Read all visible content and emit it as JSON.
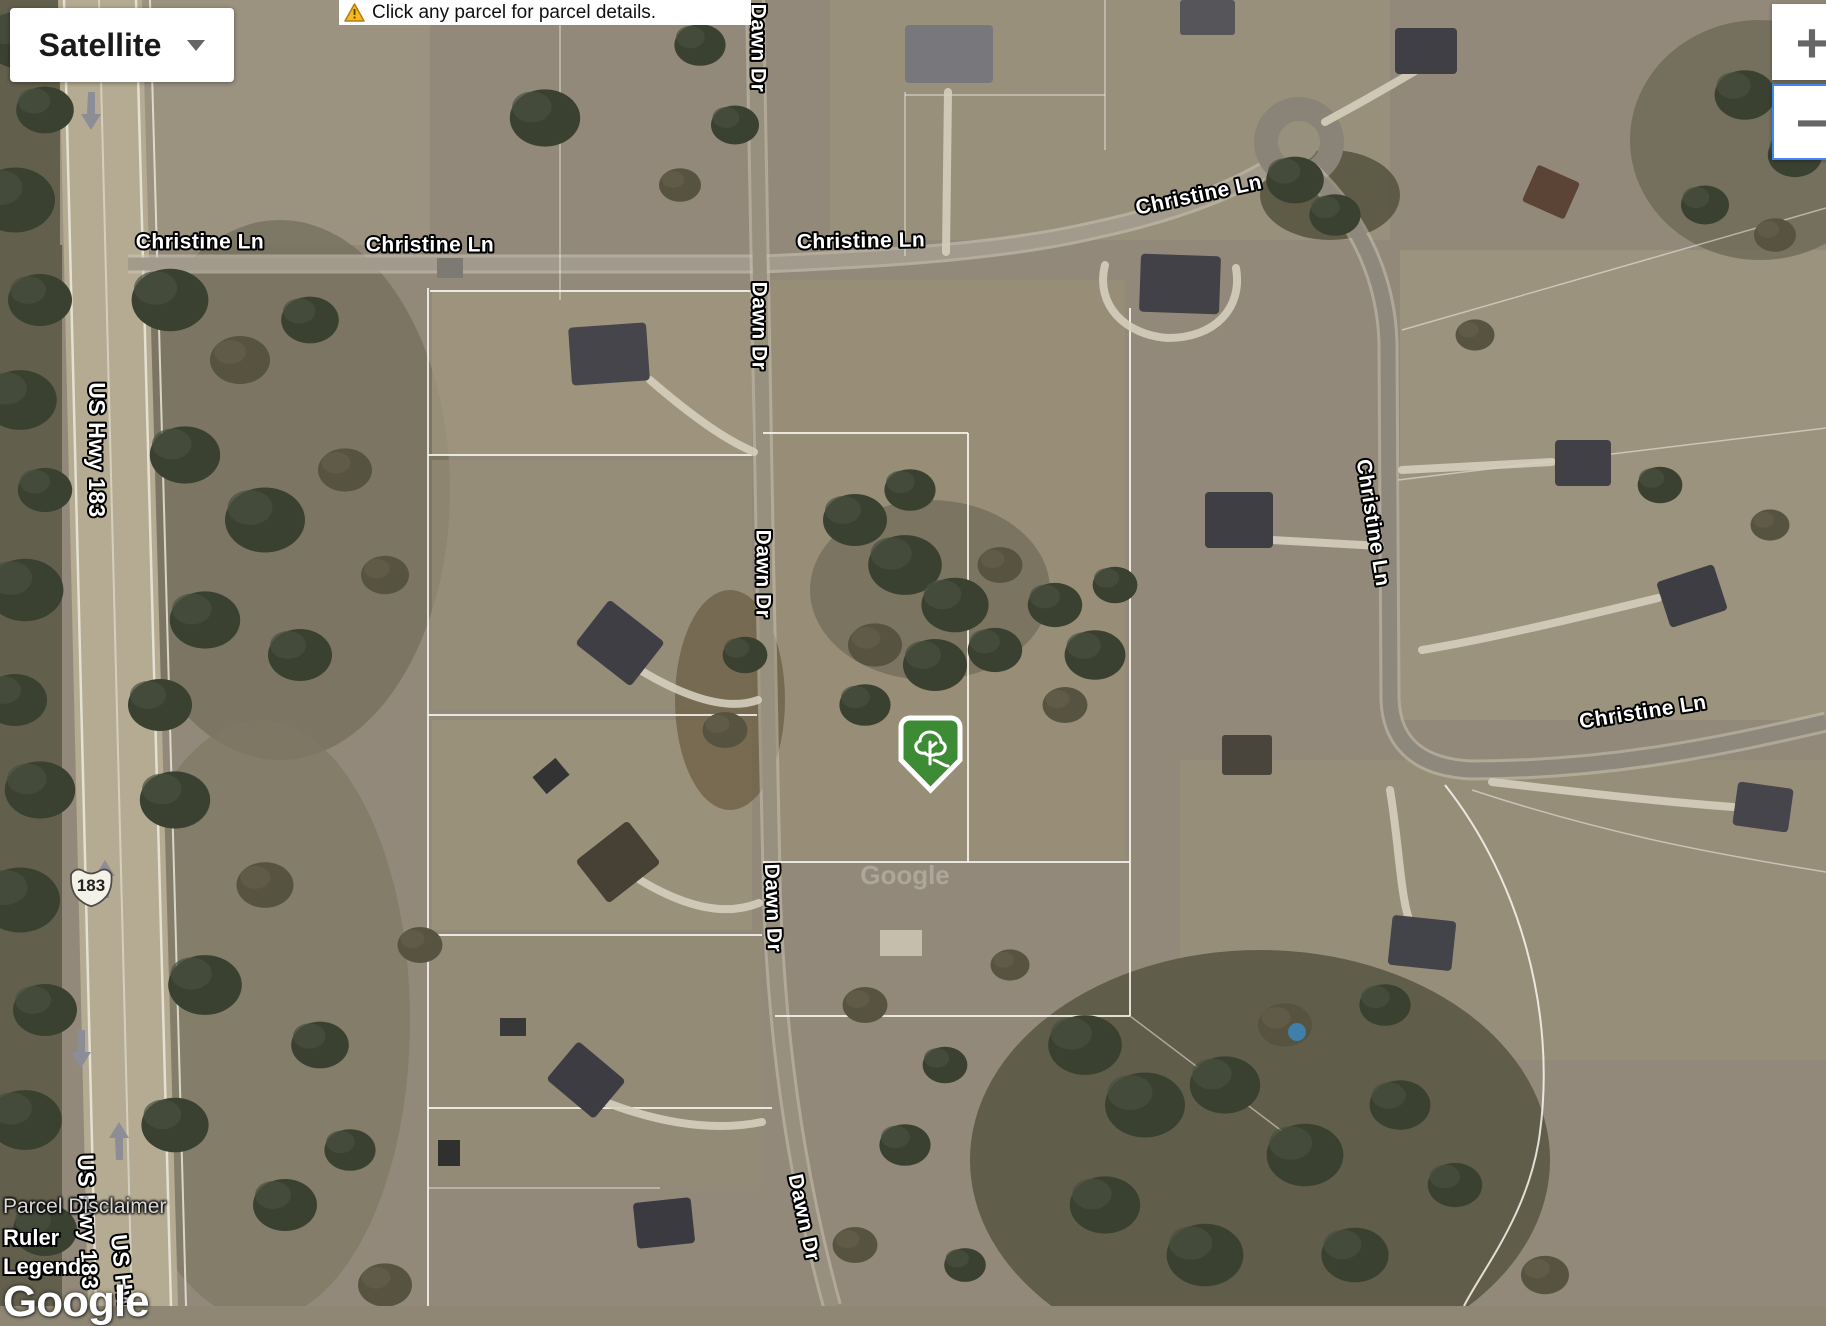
{
  "controls": {
    "map_type_label": "Satellite",
    "zoom_in_label": "+",
    "zoom_out_label": "−"
  },
  "notification": {
    "icon": "warning-triangle-icon",
    "text": "Click any parcel for parcel details."
  },
  "links": {
    "parcel_disclaimer": "Parcel Disclaimer",
    "ruler": "Ruler",
    "legend": "Legend"
  },
  "attribution": {
    "logo_text": "Google",
    "watermark_text": "Google"
  },
  "map": {
    "highway_shield": {
      "route": "183"
    },
    "marker": {
      "x": 901,
      "y": 718,
      "color": "#3d8b35",
      "icon": "tree-icon"
    },
    "road_labels": [
      {
        "text": "Christine Ln",
        "x": 200,
        "y": 243,
        "rot": 0
      },
      {
        "text": "Christine Ln",
        "x": 430,
        "y": 246,
        "rot": 0
      },
      {
        "text": "Christine Ln",
        "x": 861,
        "y": 242,
        "rot": -1
      },
      {
        "text": "Christine Ln",
        "x": 1199,
        "y": 196,
        "rot": -12
      },
      {
        "text": "Christine Ln",
        "x": 1372,
        "y": 523,
        "rot": 81
      },
      {
        "text": "Christine Ln",
        "x": 1643,
        "y": 713,
        "rot": -9
      },
      {
        "text": "Dawn Dr",
        "x": 757,
        "y": 48,
        "rot": 90
      },
      {
        "text": "Dawn Dr",
        "x": 758,
        "y": 326,
        "rot": 90
      },
      {
        "text": "Dawn Dr",
        "x": 762,
        "y": 574,
        "rot": 90
      },
      {
        "text": "Dawn Dr",
        "x": 772,
        "y": 908,
        "rot": 88
      },
      {
        "text": "Dawn Dr",
        "x": 803,
        "y": 1218,
        "rot": 78,
        "hwy": false
      },
      {
        "text": "US Hwy 183",
        "x": 95,
        "y": 450,
        "rot": 90,
        "hwy": true
      },
      {
        "text": "US Hwy 183",
        "x": 86,
        "y": 1222,
        "rot": 88,
        "hwy": true
      },
      {
        "text": "US Hwy 183",
        "x": 124,
        "y": 1302,
        "rot": 84,
        "hwy": true
      }
    ],
    "colors": {
      "accent_blue": "#4285f4",
      "warning_yellow": "#f9ba16",
      "marker_green": "#3d8b35"
    }
  }
}
